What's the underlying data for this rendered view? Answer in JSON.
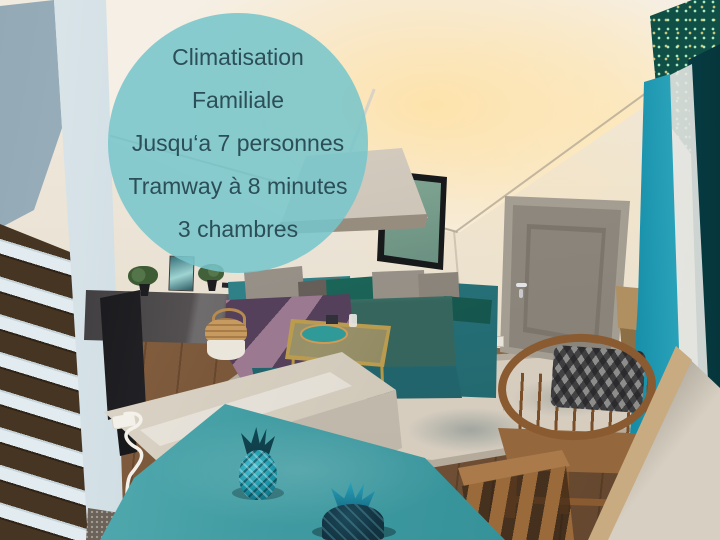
{
  "overlay": {
    "lines": [
      "Climatisation",
      "Familiale",
      "Jusqu‘a 7 personnes",
      "Tramway à 8 minutes",
      "3 chambres"
    ],
    "circle_color": "#7cc5c8",
    "text_color": "#2b4e58"
  },
  "palette": {
    "sofa_teal": "#2a7c82",
    "curtain_turquoise": "#29b3cb",
    "table_teal": "#3f9ba1",
    "wall_cream": "#ece4d6",
    "floor_wood": "#7c583b"
  }
}
